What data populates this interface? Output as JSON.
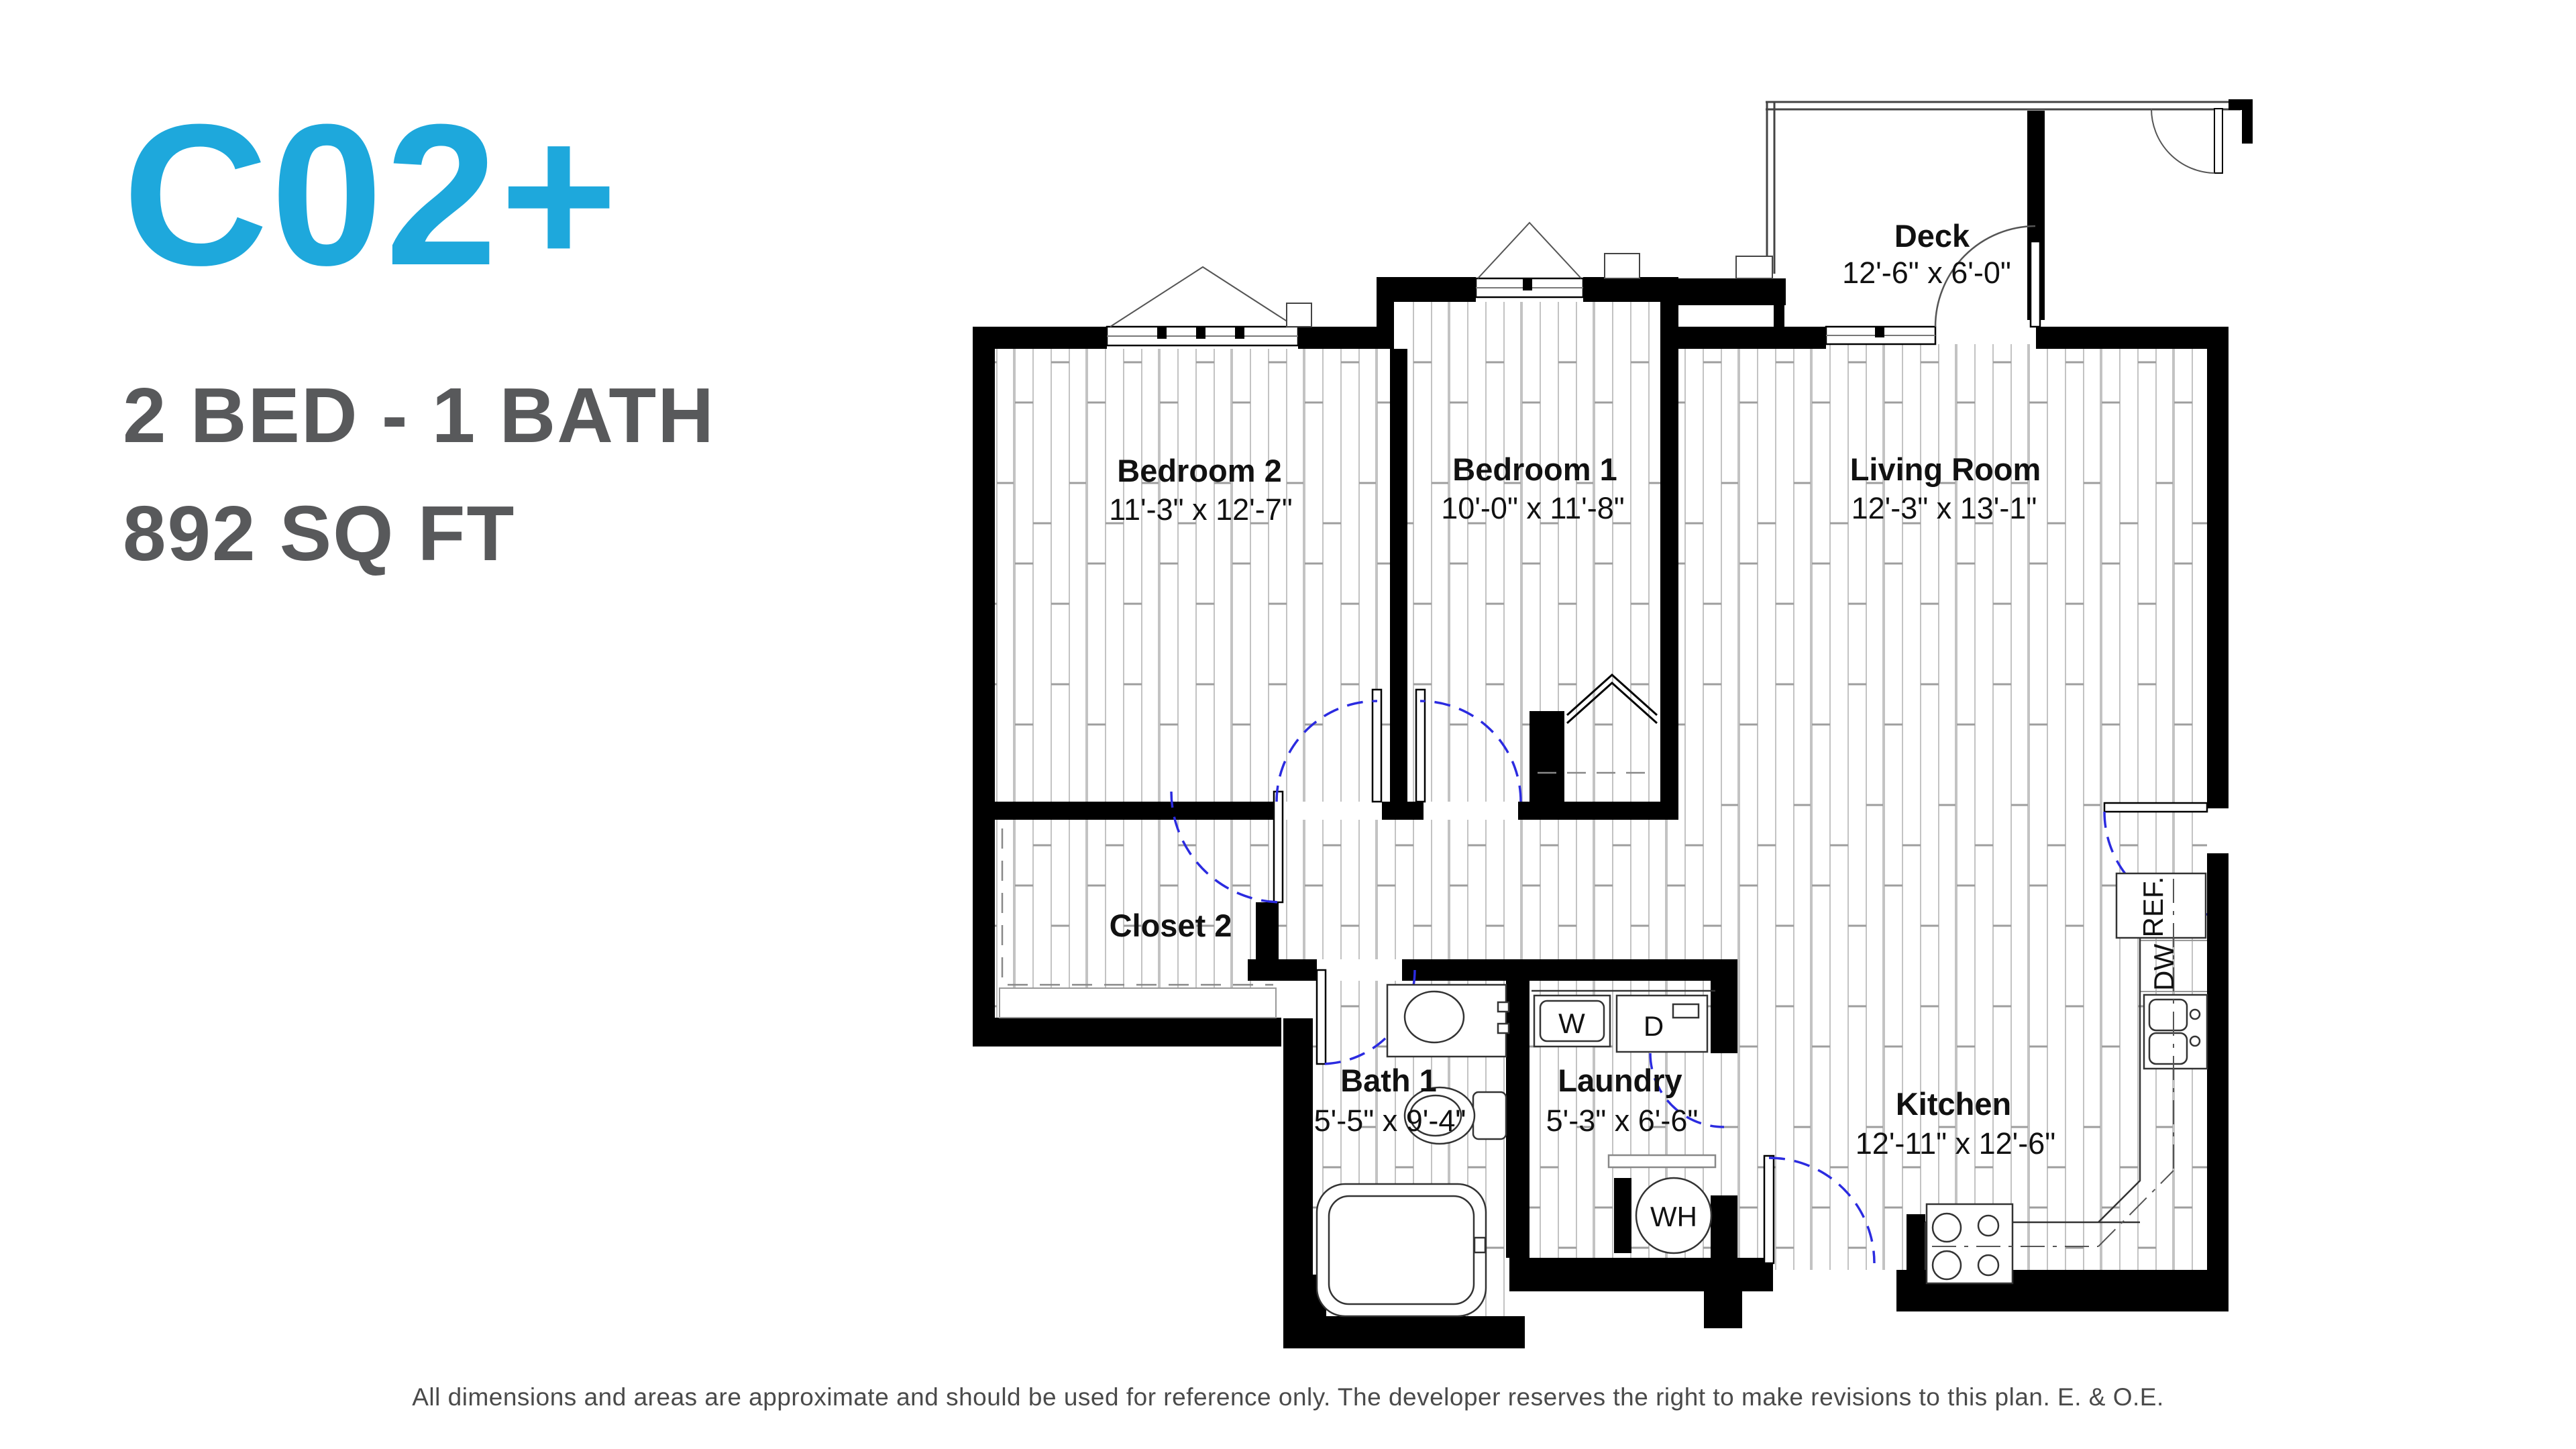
{
  "header": {
    "plan_code": "C02+",
    "spec": "2 BED - 1 BATH",
    "area": "892 SQ FT"
  },
  "colors": {
    "accent": "#1ea8dc",
    "heading_gray": "#58595b",
    "wall_black": "#000000",
    "door_swing_blue": "#2b2be0"
  },
  "rooms": {
    "deck": {
      "name": "Deck",
      "dims": "12'-6\" x 6'-0\""
    },
    "bedroom2": {
      "name": "Bedroom 2",
      "dims": "11'-3\" x 12'-7\""
    },
    "bedroom1": {
      "name": "Bedroom 1",
      "dims": "10'-0\" x 11'-8\""
    },
    "living": {
      "name": "Living Room",
      "dims": "12'-3\" x 13'-1\""
    },
    "closet2": {
      "name": "Closet 2"
    },
    "bath1": {
      "name": "Bath 1",
      "dims": "5'-5\" x 9'-4\""
    },
    "laundry": {
      "name": "Laundry",
      "dims": "5'-3\" x 6'-6\""
    },
    "kitchen": {
      "name": "Kitchen",
      "dims": "12'-11\" x 12'-6\""
    }
  },
  "appliances": {
    "washer": "W",
    "dryer": "D",
    "water_heater": "WH",
    "refrigerator": "REF.",
    "dishwasher": "DW"
  },
  "footer": {
    "disclaimer": "All dimensions and areas are approximate and should be used for reference only. The developer reserves the right to make revisions to this plan. E. & O.E."
  }
}
